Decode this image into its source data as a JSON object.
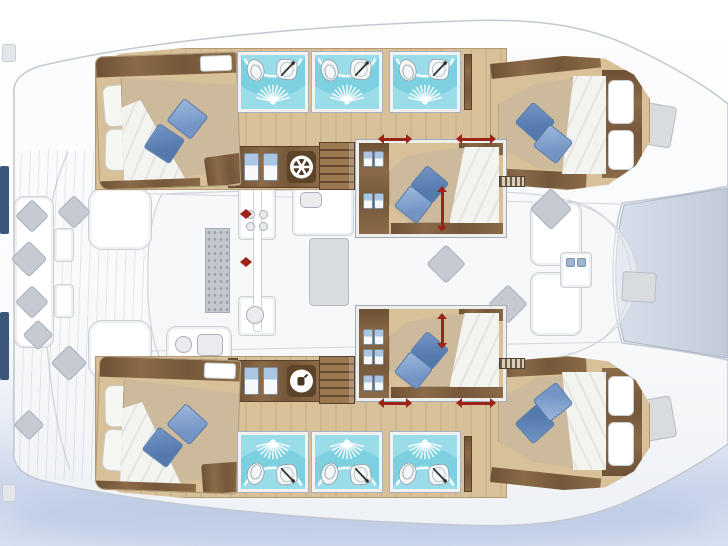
{
  "diagram": {
    "kind": "catamaran-interior-layout-plan",
    "orientation": "bow-right",
    "hulls": 2,
    "cabins_count": 6,
    "bathrooms_count": 6
  },
  "palette": {
    "page_top": "#ffffff",
    "page_bottom": "#c9d4ea",
    "hull_fill": "#fbfcfe",
    "hull_stroke": "#c2c8d1",
    "trampoline_fill": "#ccd4e2",
    "trampoline_stroke": "#aab3c3",
    "coachroof_fill": "#f4f5f7",
    "line_faint": "#d2d7dd",
    "wood_dark": "#7a5b3c",
    "floor": "#d8c099",
    "floor_stroke": "#b39a72",
    "mattress": "#cdb99c",
    "mattress_stroke": "#b3a083",
    "duvet": "#f3f3f0",
    "duvet_stroke": "#c8c8c3",
    "pillow_white": "#f6f6f3",
    "pillow_blue": "#7395c5",
    "pillow_blue_dark": "#5379ad",
    "teal": "#9bdce9",
    "teal_dark": "#64c6d8",
    "porcelain": "#f6f8f8",
    "porcelain_stroke": "#92a6af",
    "red": "#9b2318",
    "fixture_blue": "#a9c6e4",
    "faded_fill": "#edeff2",
    "faded_stroke": "#ccd1d8",
    "faded_dark": "#d9dcdf",
    "pillow_gray": "#c6cad3",
    "pillow_gray_stroke": "#aab0ba",
    "navy": "#3d5578",
    "hatch": "#d0d4d9",
    "dark_icon": "#4a3523"
  },
  "strips": [
    {
      "id": "top-hull-floor",
      "x": 95,
      "y": 48,
      "w": 412,
      "h": 142,
      "side": "top"
    },
    {
      "id": "bottom-hull-floor",
      "x": 95,
      "y": 356,
      "w": 412,
      "h": 142,
      "side": "bottom"
    }
  ],
  "partitions": [
    {
      "x": 228,
      "y": 54,
      "w": 10,
      "h": 134
    },
    {
      "x": 228,
      "y": 358,
      "w": 10,
      "h": 134
    },
    {
      "x": 464,
      "y": 54,
      "w": 8,
      "h": 56
    },
    {
      "x": 464,
      "y": 436,
      "w": 8,
      "h": 56
    }
  ],
  "bathrooms": {
    "unit_w": 70,
    "unit_h": 60,
    "rows": [
      {
        "side": "top",
        "y": 52,
        "xs": [
          238,
          312,
          390
        ]
      },
      {
        "side": "bottom",
        "y": 432,
        "xs": [
          238,
          312,
          390
        ]
      }
    ]
  },
  "cabinets": [
    {
      "x": 236,
      "y": 146,
      "w": 84,
      "h": 42,
      "fixtures": [
        7,
        26
      ],
      "icon": "ships-wheel"
    },
    {
      "x": 236,
      "y": 360,
      "w": 84,
      "h": 42,
      "fixtures": [
        7,
        26
      ],
      "icon": "appliance"
    }
  ],
  "stairs": [
    {
      "x": 319,
      "y": 142,
      "w": 36,
      "h": 48
    },
    {
      "x": 319,
      "y": 356,
      "w": 36,
      "h": 48
    }
  ],
  "grilles": [
    {
      "x": 499,
      "y": 176,
      "w": 26,
      "h": 11
    },
    {
      "x": 499,
      "y": 358,
      "w": 26,
      "h": 11
    }
  ],
  "cabins": [
    {
      "id": "cabin-aft-port",
      "type": "aft",
      "x": 97,
      "y": 54,
      "w": 142,
      "h": 134,
      "rot": -2,
      "flip": false
    },
    {
      "id": "cabin-aft-starboard",
      "type": "aft",
      "x": 97,
      "y": 358,
      "w": 142,
      "h": 134,
      "rot": 2,
      "flip": false
    },
    {
      "id": "cabin-fwd-port",
      "type": "fwd",
      "x": 490,
      "y": 56,
      "w": 160,
      "h": 134,
      "rot": 0,
      "flip": false
    },
    {
      "id": "cabin-fwd-starboard",
      "type": "fwd",
      "x": 490,
      "y": 356,
      "w": 160,
      "h": 134,
      "rot": 0,
      "flip": true
    },
    {
      "id": "cabin-center-fwd",
      "type": "center",
      "x": 356,
      "y": 140,
      "w": 150,
      "h": 97,
      "fixtures": [
        8,
        50
      ]
    },
    {
      "id": "cabin-center-aft",
      "type": "center",
      "x": 356,
      "y": 306,
      "w": 150,
      "h": 95,
      "fixtures": [
        20,
        40,
        66
      ]
    }
  ],
  "arrows": [
    {
      "dir": "h",
      "cx": 395,
      "cy": 139,
      "len": 34
    },
    {
      "dir": "h",
      "cx": 476,
      "cy": 139,
      "len": 40
    },
    {
      "dir": "h",
      "cx": 395,
      "cy": 403,
      "len": 34
    },
    {
      "dir": "h",
      "cx": 476,
      "cy": 403,
      "len": 40
    },
    {
      "dir": "v",
      "cx": 442,
      "cy": 209,
      "len": 46
    },
    {
      "dir": "v",
      "cx": 442,
      "cy": 331,
      "len": 36
    },
    {
      "dir": "h",
      "cx": 246,
      "cy": 214,
      "len": 12
    },
    {
      "dir": "h",
      "cx": 246,
      "cy": 262,
      "len": 12
    }
  ],
  "faded": {
    "boxes": [
      {
        "x": 14,
        "y": 196,
        "w": 40,
        "h": 152,
        "r": 10,
        "name": "cockpit-bench"
      },
      {
        "x": 54,
        "y": 228,
        "w": 20,
        "h": 34,
        "r": 4,
        "name": "cockpit-side-table"
      },
      {
        "x": 54,
        "y": 284,
        "w": 20,
        "h": 34,
        "r": 4,
        "name": "cockpit-side-table"
      },
      {
        "x": 88,
        "y": 188,
        "w": 64,
        "h": 62,
        "r": 14,
        "name": "cockpit-table"
      },
      {
        "x": 88,
        "y": 320,
        "w": 64,
        "h": 58,
        "r": 14,
        "name": "cockpit-sofa"
      },
      {
        "x": 166,
        "y": 326,
        "w": 66,
        "h": 42,
        "r": 10,
        "name": "saloon-seat"
      },
      {
        "x": 238,
        "y": 184,
        "w": 38,
        "h": 56,
        "r": 4,
        "name": "galley-counter"
      },
      {
        "x": 238,
        "y": 296,
        "w": 38,
        "h": 40,
        "r": 4,
        "name": "galley-counter"
      },
      {
        "x": 292,
        "y": 180,
        "w": 62,
        "h": 56,
        "r": 6,
        "name": "galley-island"
      },
      {
        "x": 530,
        "y": 202,
        "w": 52,
        "h": 64,
        "r": 10,
        "name": "foredeck-seat"
      },
      {
        "x": 530,
        "y": 272,
        "w": 52,
        "h": 64,
        "r": 10,
        "name": "foredeck-seat"
      },
      {
        "x": 560,
        "y": 252,
        "w": 32,
        "h": 36,
        "r": 4,
        "name": "foredeck-locker"
      }
    ],
    "gray_boxes": [
      {
        "x": 309,
        "y": 238,
        "w": 40,
        "h": 68,
        "r": 4,
        "rot": 0,
        "name": "saloon-table"
      },
      {
        "x": 622,
        "y": 272,
        "w": 34,
        "h": 30,
        "r": 3,
        "rot": 3,
        "name": "deck-hatch"
      },
      {
        "x": 638,
        "y": 104,
        "w": 36,
        "h": 42,
        "r": 4,
        "rot": 10,
        "name": "bow-hatch"
      },
      {
        "x": 638,
        "y": 398,
        "w": 36,
        "h": 42,
        "r": 4,
        "rot": -10,
        "name": "bow-hatch"
      }
    ],
    "white_strip": {
      "x": 253,
      "y": 186,
      "w": 9,
      "h": 146
    },
    "mat": {
      "x": 205,
      "y": 228,
      "w": 25,
      "h": 85
    },
    "pillows": [
      {
        "x": 20,
        "y": 204,
        "s": 24
      },
      {
        "x": 16,
        "y": 246,
        "s": 26
      },
      {
        "x": 20,
        "y": 290,
        "s": 24
      },
      {
        "x": 27,
        "y": 324,
        "s": 22
      },
      {
        "x": 56,
        "y": 350,
        "s": 26
      },
      {
        "x": 62,
        "y": 200,
        "s": 24
      },
      {
        "x": 18,
        "y": 414,
        "s": 22
      },
      {
        "x": 536,
        "y": 194,
        "s": 30
      },
      {
        "x": 432,
        "y": 250,
        "s": 28
      },
      {
        "x": 494,
        "y": 290,
        "s": 28
      }
    ],
    "icons": [
      {
        "type": "circle",
        "x": 175,
        "y": 336,
        "s": 17
      },
      {
        "type": "rsq",
        "x": 197,
        "y": 334,
        "w": 26,
        "h": 22
      },
      {
        "type": "circle",
        "x": 246,
        "y": 306,
        "s": 18
      },
      {
        "type": "rsq",
        "x": 300,
        "y": 192,
        "w": 22,
        "h": 16
      },
      {
        "type": "circle",
        "x": 246,
        "y": 210,
        "s": 9
      },
      {
        "type": "circle",
        "x": 259,
        "y": 210,
        "s": 9
      },
      {
        "type": "circle",
        "x": 246,
        "y": 222,
        "s": 9
      },
      {
        "type": "circle",
        "x": 259,
        "y": 222,
        "s": 9
      },
      {
        "type": "chip",
        "x": 566,
        "y": 258,
        "s": 9
      },
      {
        "type": "chip",
        "x": 577,
        "y": 258,
        "s": 9
      }
    ]
  },
  "stern": {
    "navy_bars": [
      {
        "x": 0,
        "y": 166,
        "w": 9,
        "h": 68
      },
      {
        "x": 0,
        "y": 312,
        "w": 9,
        "h": 68
      }
    ],
    "steps": [
      {
        "x": 2,
        "y": 44,
        "w": 14,
        "h": 18
      },
      {
        "x": 2,
        "y": 484,
        "w": 14,
        "h": 18
      }
    ]
  }
}
